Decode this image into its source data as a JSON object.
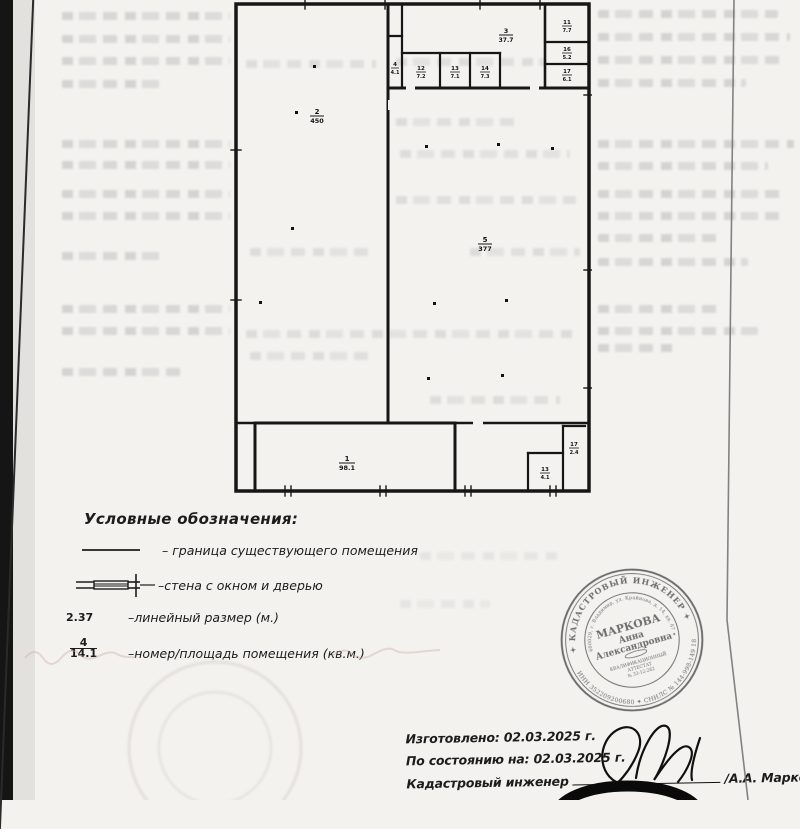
{
  "legend": {
    "title": "Условные обозначения:",
    "boundary_label": "– граница существующего помещения",
    "wall_label": "–стена с окном и дверью",
    "linear_symbol": "2.37",
    "linear_label": "–линейный размер (м.)",
    "room_symbol_num": "4",
    "room_symbol_den": "14.1",
    "room_label": "–номер/площадь помещения (кв.м.)"
  },
  "plan": {
    "rooms": {
      "left_big": {
        "num": "2",
        "den": "450"
      },
      "main": {
        "num": "5",
        "den": "377"
      },
      "top_wide": {
        "num": "3",
        "den": "37.7"
      },
      "narrow": {
        "num": "4",
        "den": "4.1"
      },
      "row_1": {
        "num": "12",
        "den": "7.2"
      },
      "row_2": {
        "num": "13",
        "den": "7.1"
      },
      "row_3": {
        "num": "14",
        "den": "7.3"
      },
      "col_1": {
        "num": "11",
        "den": "7.7"
      },
      "col_2": {
        "num": "16",
        "den": "5.2"
      },
      "col_3": {
        "num": "17",
        "den": "6.1"
      },
      "bottom_left": {
        "num": "1",
        "den": "98.1"
      },
      "bottom_square": {
        "num": "13",
        "den": "4.1"
      },
      "bottom_narrow": {
        "num": "17",
        "den": "2.4"
      }
    }
  },
  "stamp": {
    "outer_top": "✦ КАДАСТРОВЫЙ ИНЖЕНЕР ✦",
    "outer_bottom": "ИНН 352209200680  ✦  СНИЛС № 144-998-149 18",
    "inner_ring": "600029, г. Владимир, ул. Крайнова, д. 14, кв. 67 ✦",
    "surname": "МАРКОВА",
    "first_name": "Анна",
    "patronymic": "Александровна",
    "attestation_1": "КВАЛИФИКАЦИОННЫЙ",
    "attestation_2": "АТТЕСТАТ",
    "attestation_3": "№ 33-12-262"
  },
  "footer": {
    "made": "Изготовлено: 02.03.2025 г.",
    "as_of": "По состоянию на: 02.03.2025 г.",
    "engineer": "Кадастровый инженер",
    "name": "/А.А. Маркова"
  }
}
